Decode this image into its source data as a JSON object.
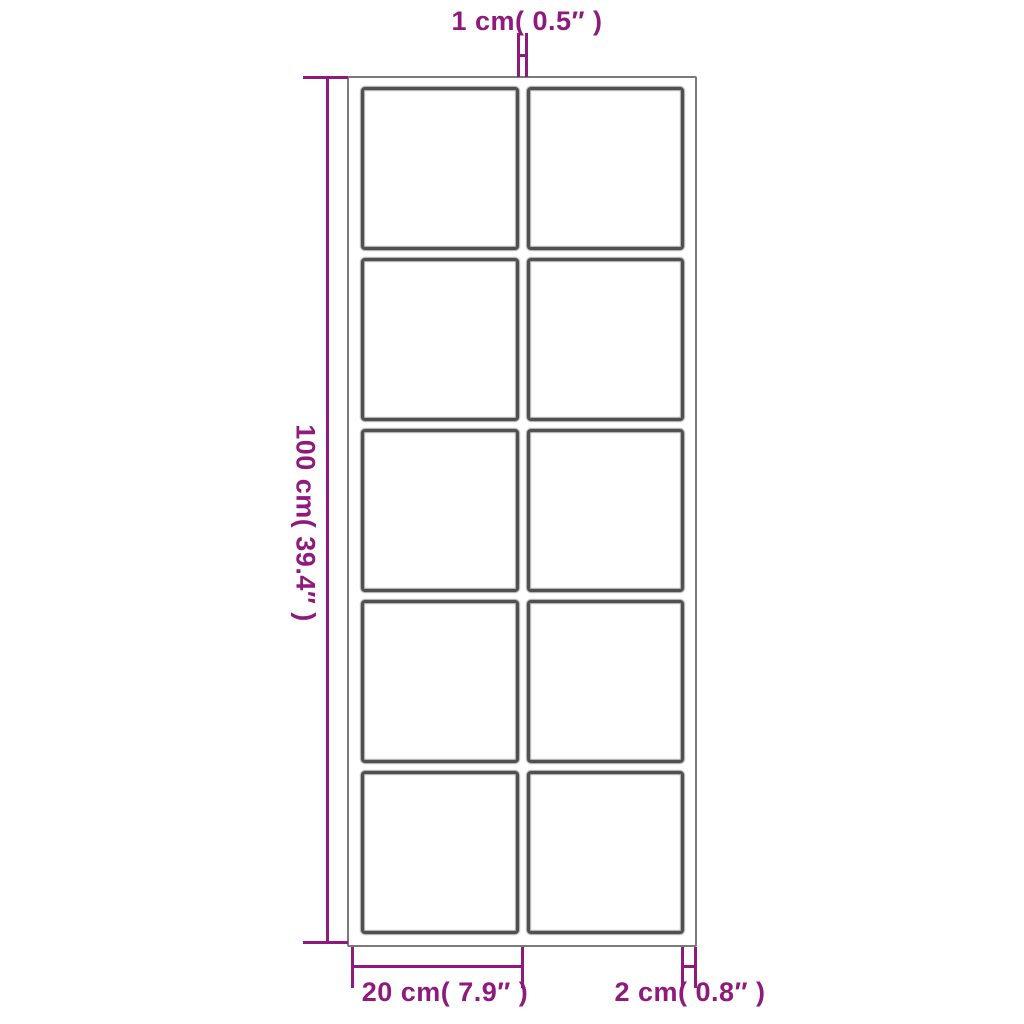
{
  "diagram": {
    "subject": "paned-frame-dimension-diagram",
    "frame": {
      "columns": 2,
      "rows": 5,
      "pane_count": 10
    },
    "dimensions": {
      "top_divider_width": {
        "label": "1 cm( 0.5″  )"
      },
      "left_height": {
        "label": "100 cm( 39.4″  )"
      },
      "bottom_pane_width": {
        "label": "20 cm( 7.9″  )"
      },
      "bottom_frame_thickness": {
        "label": "2 cm( 0.8″  )"
      }
    },
    "colors": {
      "dimension_accent": "#8d1a7c",
      "frame_border_dark": "#505050",
      "frame_border_light": "#7a7a7a",
      "background": "#ffffff"
    }
  }
}
